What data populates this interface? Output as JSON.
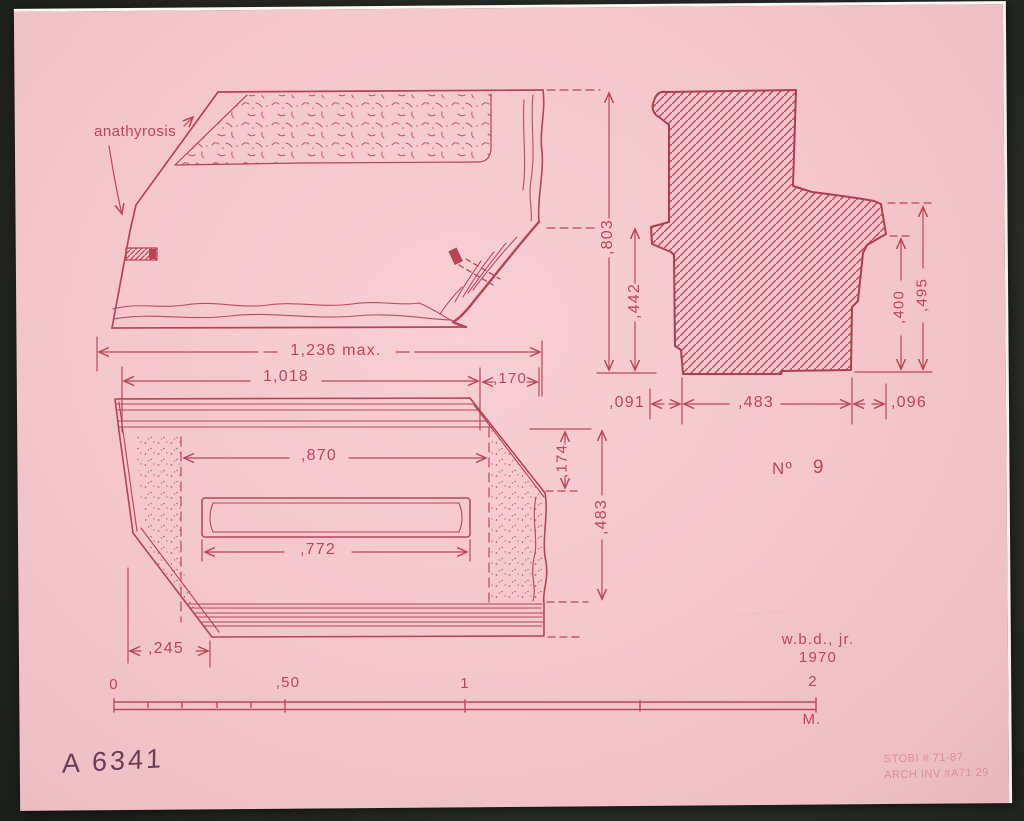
{
  "sheet": {
    "figure_prefix": "Nº",
    "figure_number": "9",
    "draftsman": "w.b.d., jr.",
    "year": "1970",
    "catalog_number": "A 6341",
    "stamp_line1": "STOBI # 71-87",
    "stamp_line2": "ARCH INV #A71 29",
    "anathyrosis_label": "anathyrosis"
  },
  "dims": {
    "elevation_total": "1,236 max.",
    "elevation_left": "1,018",
    "elevation_right": ",170",
    "plan_top_width": ",870",
    "plan_recess_width": ",772",
    "plan_left_offset": ",245",
    "plan_right_upper": ",174",
    "plan_right_lower": ",483",
    "section_height_outer": ",803",
    "section_height_inner": ",442",
    "section_right_inner": ",400",
    "section_right_outer": ",495",
    "section_bottom_left": ",091",
    "section_bottom_middle": ",483",
    "section_bottom_right": ",096"
  },
  "scale_bar": {
    "tick_0": "0",
    "tick_half": ",50",
    "tick_1": "1",
    "tick_2": "2",
    "unit": "M."
  },
  "colors": {
    "paper": "#f3c7cc",
    "ink": "#c04457",
    "ink_strong": "#b23c50",
    "handwriting": "#6e3a55",
    "stamp": "#dd858c",
    "background": "#272a26"
  }
}
